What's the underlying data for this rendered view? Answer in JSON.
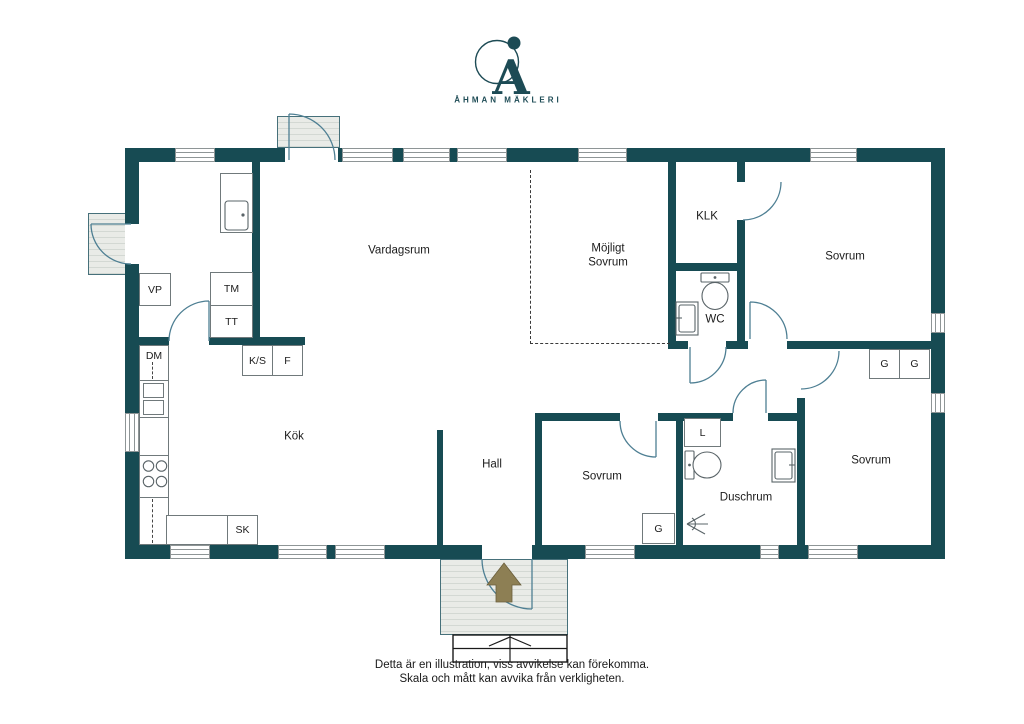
{
  "branding": {
    "logo_letter": "A",
    "logo_name": "ÅHMAN MÄKLERI"
  },
  "rooms": {
    "vardagsrum": "Vardagsrum",
    "mojligt_sovrum_line1": "Möjligt",
    "mojligt_sovrum_line2": "Sovrum",
    "klk": "KLK",
    "wc": "WC",
    "sovrum_ne": "Sovrum",
    "sovrum_mid": "Sovrum",
    "sovrum_se": "Sovrum",
    "duschrum": "Duschrum",
    "hall": "Hall",
    "kok": "Kök"
  },
  "fixtures": {
    "vp": "VP",
    "tm": "TM",
    "tt": "TT",
    "dm": "DM",
    "ks": "K/S",
    "f": "F",
    "sk": "SK",
    "l": "L",
    "g_mid": "G",
    "g_se_1": "G",
    "g_se_2": "G"
  },
  "disclaimer": {
    "line1": "Detta är en illustration, viss avvikelse kan förekomma.",
    "line2": "Skala och mått kan avvika från verkligheten."
  },
  "colors": {
    "wall": "#174b53",
    "door_arc": "#4e7f93",
    "porch_fill": "#e9ebe7",
    "porch_stripe": "#d3d8d3",
    "arrow": "#8d7f54",
    "brand": "#1d4b55",
    "fixture_line": "#5a6468",
    "text": "#1c1c1c"
  }
}
